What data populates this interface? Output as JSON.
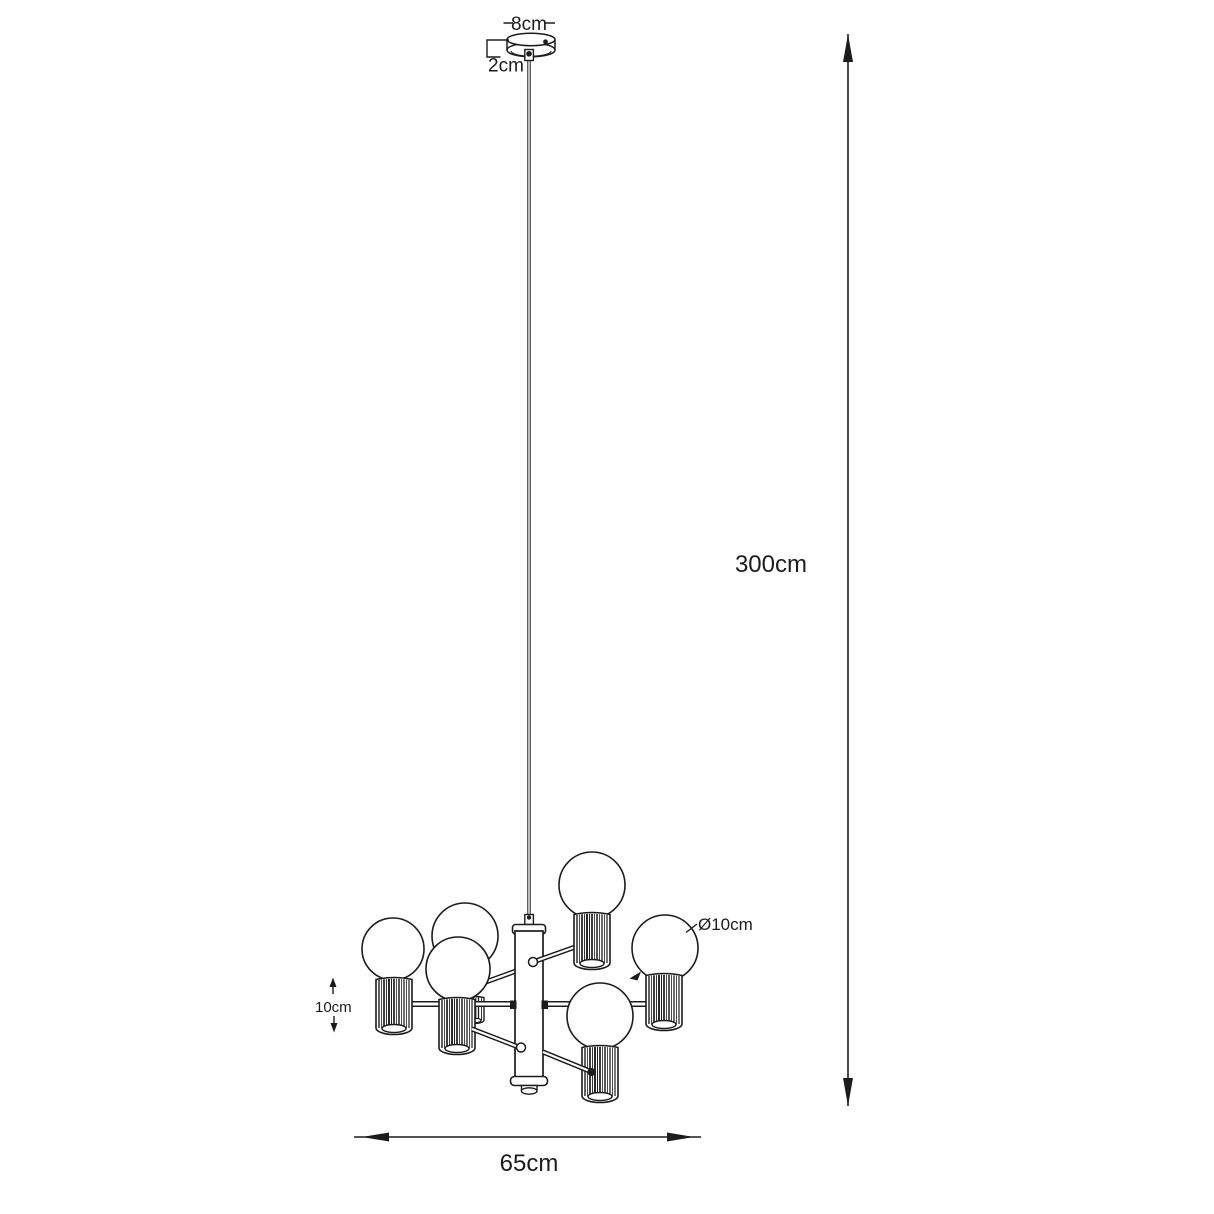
{
  "canvas": {
    "background": "#ffffff",
    "line_color": "#1c1c1c"
  },
  "diagram": {
    "subject": "6-light pendant chandelier technical dimension drawing",
    "labels": {
      "canopy_width": "8cm",
      "canopy_height": "2cm",
      "drop_height": "300cm",
      "fixture_width": "65cm",
      "shade_height": "10cm",
      "bulb_diameter": "Ø10cm"
    }
  }
}
